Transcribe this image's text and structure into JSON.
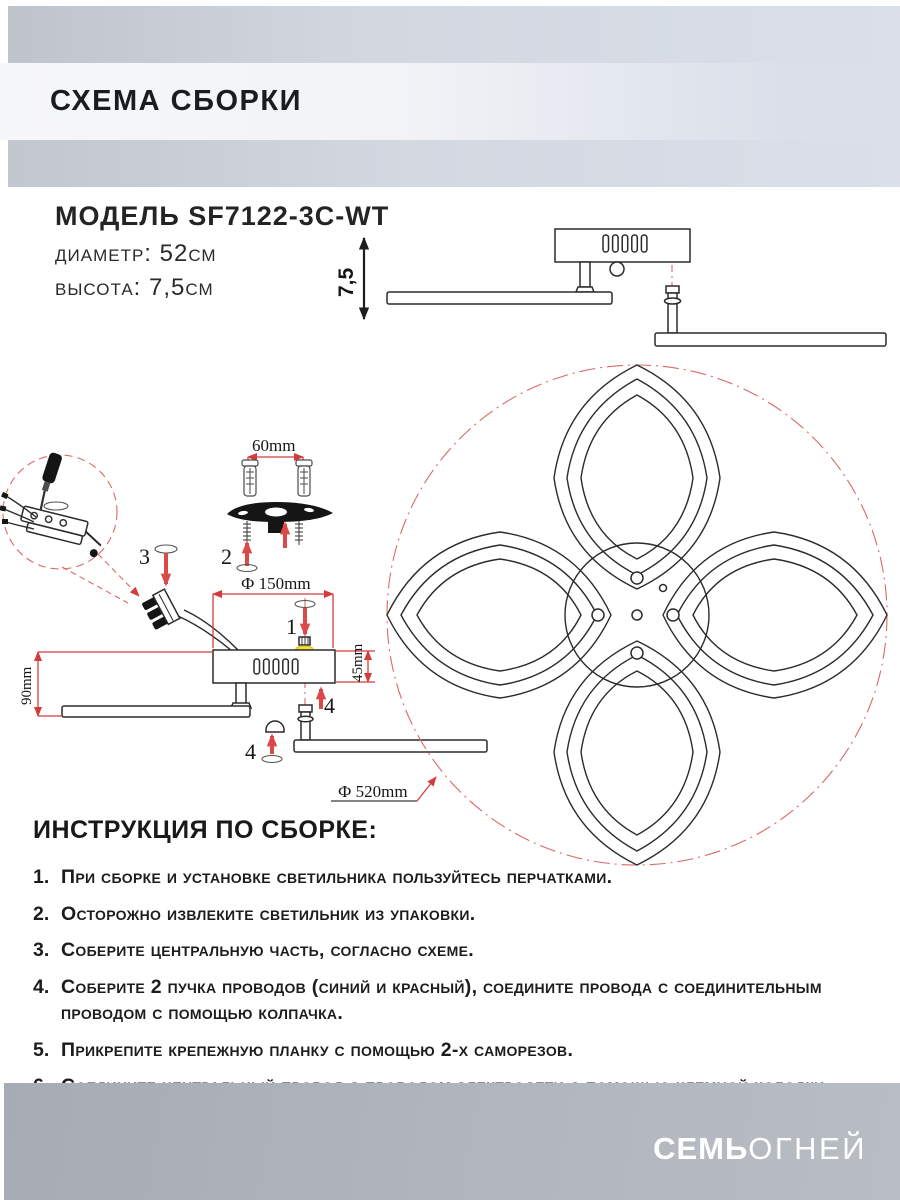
{
  "header": {
    "title": "СХЕМА СБОРКИ"
  },
  "model": {
    "name": "МОДЕЛЬ SF7122-3C-WT",
    "diameter": "диаметр: 52см",
    "height": "высота: 7,5см"
  },
  "diagram": {
    "height_label": "7,5",
    "dim_60": "60mm",
    "dim_150": "Ф 150mm",
    "dim_45": "45mm",
    "dim_90": "90mm",
    "dim_520": "Ф 520mm",
    "step_1": "1",
    "step_2": "2",
    "step_3": "3",
    "step_4_right": "4",
    "step_4_bottom": "4",
    "colors": {
      "dimension_red": "#d43c3c",
      "centerline_red": "#da6868",
      "outline_black": "#2b2b2b",
      "highlight_yellow": "#f2e33c"
    }
  },
  "instructions": {
    "title": "ИНСТРУКЦИЯ ПО СБОРКЕ:",
    "items": [
      {
        "num": "1.",
        "text": "При сборке и установке светильника пользуйтесь перчатками."
      },
      {
        "num": "2.",
        "text": "Осторожно извлеките светильник из упаковки."
      },
      {
        "num": "3.",
        "text": "Соберите центральную часть, согласно схеме."
      },
      {
        "num": "4.",
        "text": "Соберите 2 пучка проводов (синий и красный), соедините провода с соединительным проводом с помощью колпачка."
      },
      {
        "num": "5.",
        "text": "Прикрепите крепежную планку с помощью 2-х саморезов."
      },
      {
        "num": "6.",
        "text": "Соедините центральный провод с проводом электросети с помощью клемной колодки."
      }
    ]
  },
  "footer": {
    "brand_bold": "СЕМЬ",
    "brand_light": "ОГНЕЙ"
  }
}
